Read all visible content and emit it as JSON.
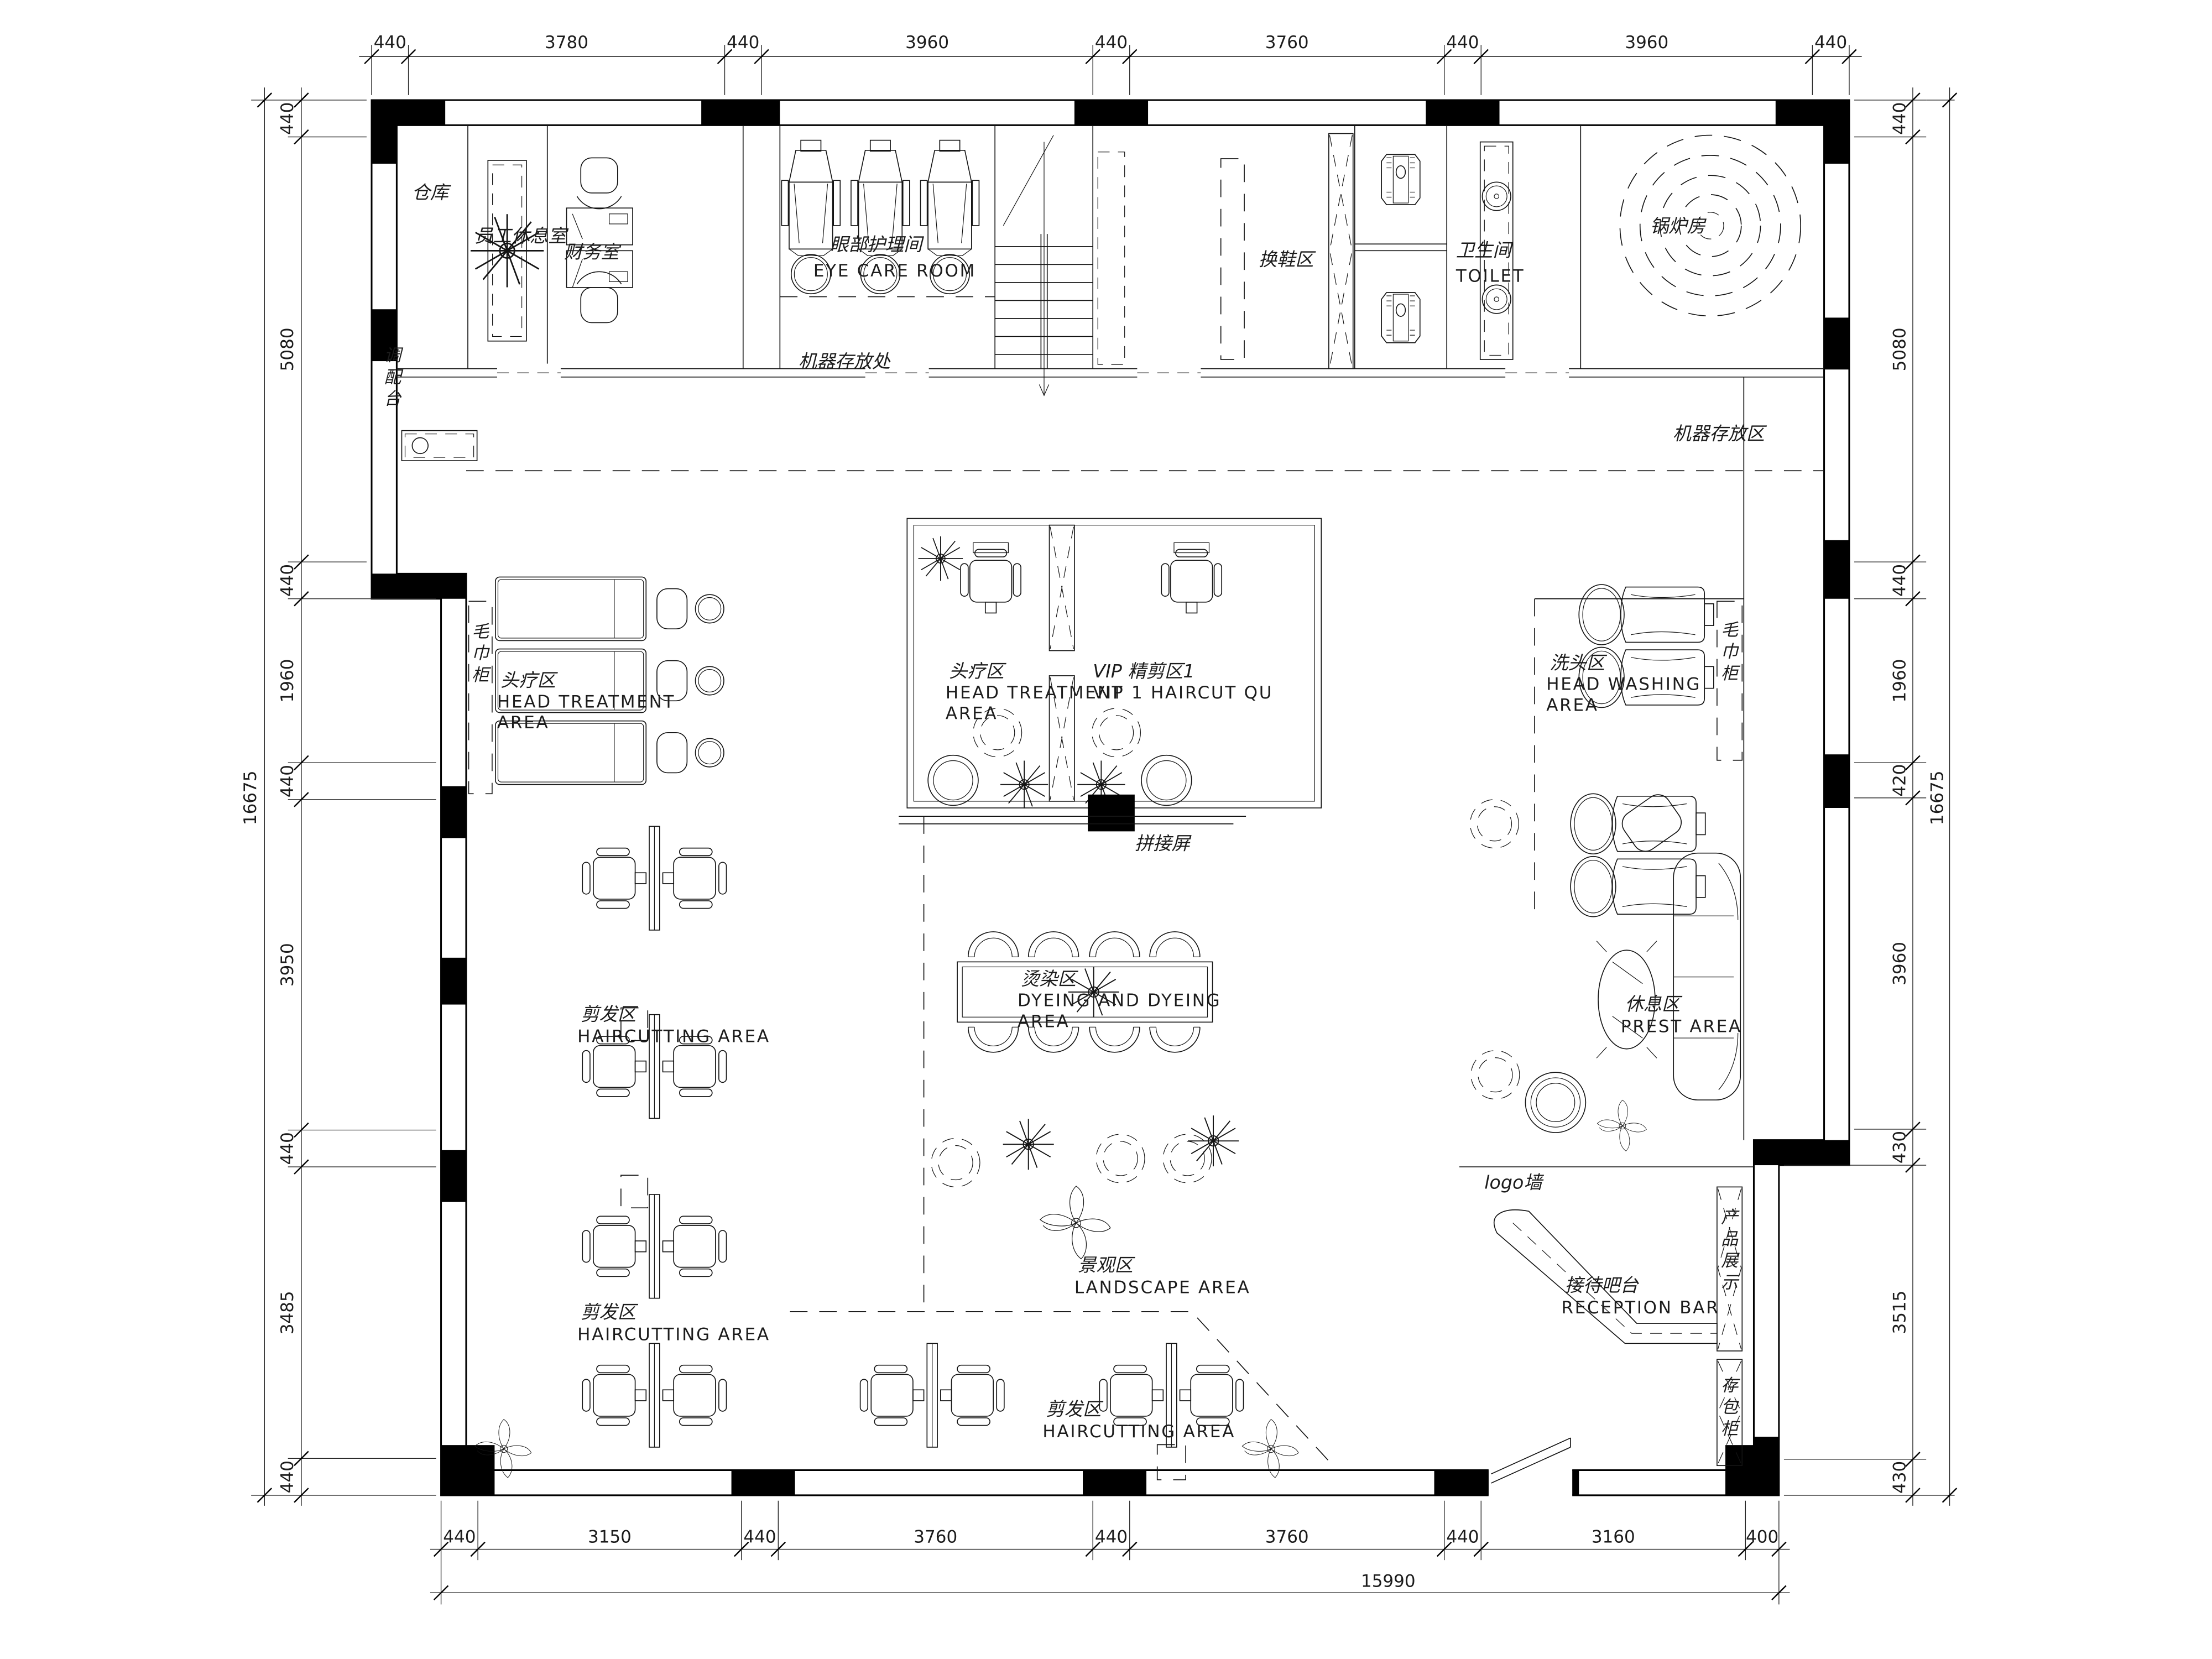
{
  "drawing": {
    "type": "salon-floor-plan",
    "units": "mm",
    "line_color": "#000000",
    "background": "#ffffff"
  },
  "dims": {
    "top": [
      "440",
      "3780",
      "440",
      "3960",
      "440",
      "3760",
      "440",
      "3960",
      "440"
    ],
    "bottom": [
      "440",
      "3150",
      "440",
      "3760",
      "440",
      "3760",
      "440",
      "3160",
      "400"
    ],
    "bottom_total": "15990",
    "left": [
      "440",
      "5080",
      "440",
      "1960",
      "440",
      "3950",
      "440",
      "3485",
      "440"
    ],
    "left_total": "16675",
    "right": [
      "440",
      "5080",
      "440",
      "1960",
      "420",
      "3960",
      "430",
      "3515",
      "430"
    ],
    "right_total": "16675"
  },
  "rooms": {
    "warehouse": {
      "cn": "仓库"
    },
    "staff_lounge": {
      "cn": "员工休息室"
    },
    "finance": {
      "cn": "财务室"
    },
    "eye_care": {
      "cn": "眼部护理间",
      "en": "EYE CARE ROOM"
    },
    "machine_storage_spot": {
      "cn": "机器存放处"
    },
    "mixing_counter": {
      "cn": "调配台"
    },
    "shoe_change": {
      "cn": "换鞋区"
    },
    "toilet": {
      "cn": "卫生间",
      "en": "TOILET"
    },
    "boiler": {
      "cn": "锅炉房"
    },
    "machine_storage_area": {
      "cn": "机器存放区"
    },
    "towel_cabinet": {
      "cn": "毛巾柜"
    },
    "head_treatment": {
      "cn": "头疗区",
      "en1": "HEAD TREATMENT",
      "en2": "AREA"
    },
    "vip_haircut": {
      "cn": "VIP 精剪区1",
      "en": "VIP 1 HAIRCUT QU"
    },
    "head_washing": {
      "cn": "洗头区",
      "en1": "HEAD WASHING",
      "en2": "AREA"
    },
    "splice_screen": {
      "cn": "拼接屏"
    },
    "dyeing": {
      "cn": "烫染区",
      "en1": "DYEING AND DYEING",
      "en2": "AREA"
    },
    "rest": {
      "cn": "休息区",
      "en": "PREST AREA"
    },
    "haircutting": {
      "cn": "剪发区",
      "en": "HAIRCUTTING AREA"
    },
    "landscape": {
      "cn": "景观区",
      "en": "LANDSCAPE AREA"
    },
    "logo_wall": {
      "cn": "logo墙"
    },
    "reception": {
      "cn": "接待吧台",
      "en": "RECEPTION BAR"
    },
    "display_cabinet": {
      "cn": "产品展示"
    },
    "bag_locker": {
      "cn": "存包柜"
    }
  }
}
